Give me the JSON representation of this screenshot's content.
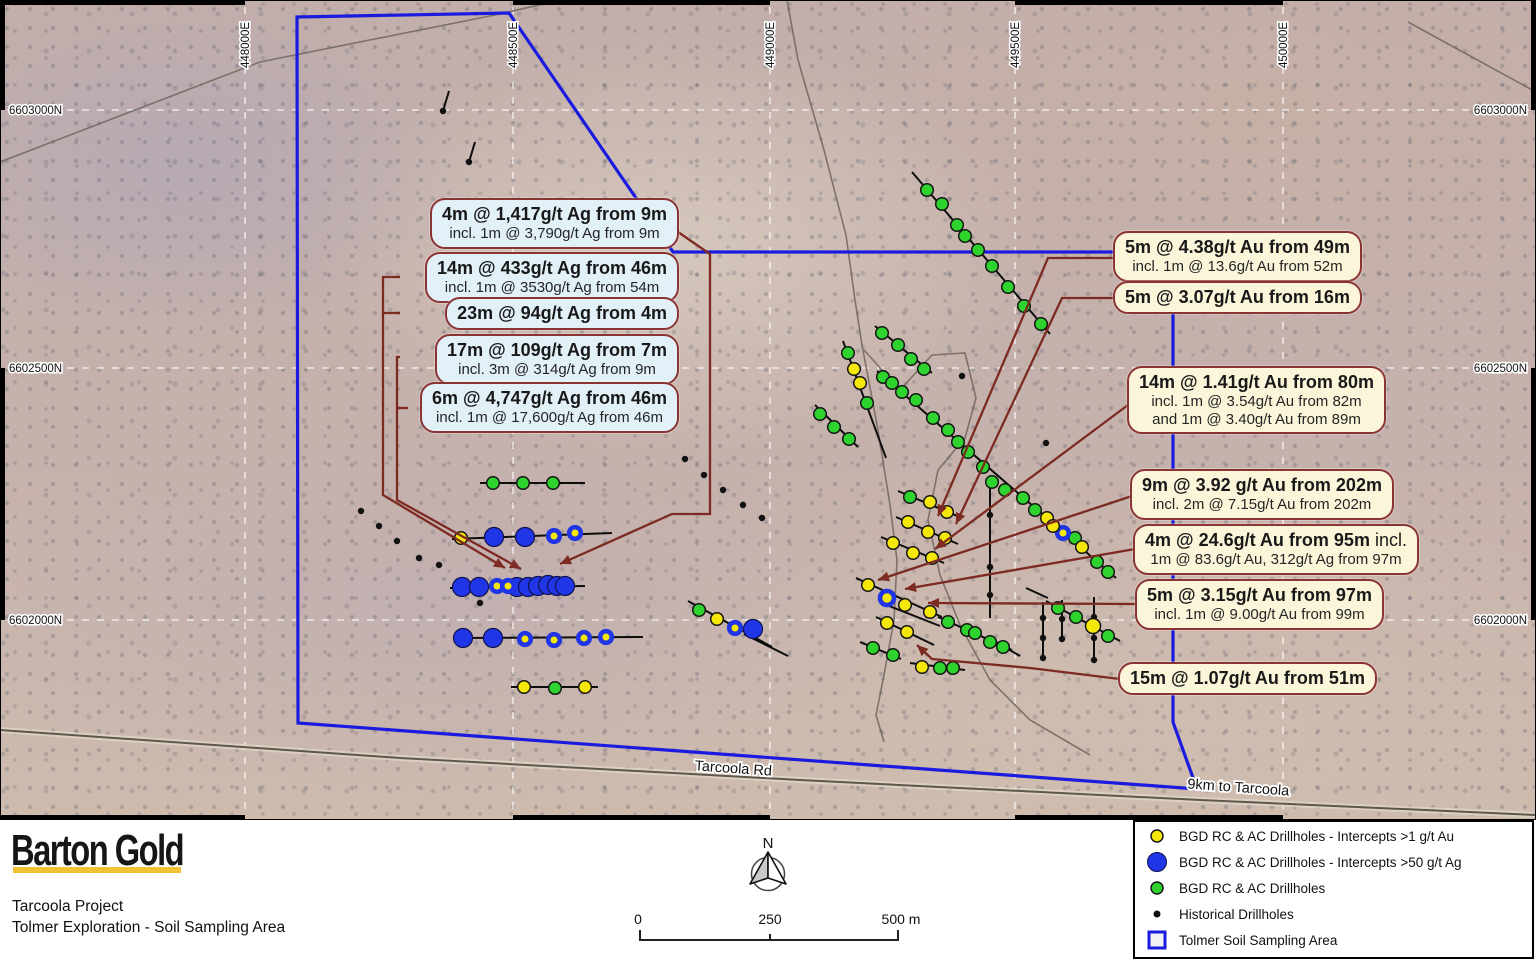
{
  "title": "Tolmer Exploration - Soil Sampling Area map",
  "colors": {
    "polygon_blue": "#1b1bdf",
    "callout_border": "#8b3434",
    "callout_left_bg": "#e2f0f7",
    "callout_right_bg": "#fbf5da",
    "leader": "#7c2a22",
    "dot_yellow": "#f6e70a",
    "dot_green": "#2ed32e",
    "dot_blue": "#2036e6",
    "dot_black": "#111111",
    "trace_black": "#0d0d0d",
    "road_gray": "#5f574d",
    "track_gray": "#6e665c",
    "logo_yellow": "#f2c233"
  },
  "grid": {
    "easting_labels": [
      {
        "text": "448000E",
        "x": 245
      },
      {
        "text": "448500E",
        "x": 513
      },
      {
        "text": "449000E",
        "x": 770
      },
      {
        "text": "449500E",
        "x": 1015
      },
      {
        "text": "450000E",
        "x": 1283
      }
    ],
    "northing_labels": [
      {
        "text": "6603000N",
        "y": 110
      },
      {
        "text": "6602500N",
        "y": 368
      },
      {
        "text": "6602000N",
        "y": 620
      }
    ],
    "vlines": [
      245,
      513,
      770,
      1015,
      1283
    ],
    "hlines": [
      110,
      368,
      620
    ]
  },
  "map_labels": {
    "road": {
      "text": "Tarcoola Rd",
      "x": 733,
      "y": 773,
      "rot": 4
    },
    "distance": {
      "text": "9km to Tarcoola",
      "x": 1238,
      "y": 792,
      "rot": 4
    }
  },
  "callouts_left": [
    {
      "title": "4m @ 1,417g/t Ag from 9m",
      "sub": [
        "incl. 1m @ 3,790g/t Ag from 9m"
      ],
      "top": 198
    },
    {
      "title": "14m @ 433g/t Ag from 46m",
      "sub": [
        "incl. 1m @ 3530g/t Ag from 54m"
      ],
      "top": 252
    },
    {
      "title": "23m @ 94g/t Ag from 4m",
      "sub": [],
      "top": 297
    },
    {
      "title": "17m @ 109g/t Ag from 7m",
      "sub": [
        "incl. 3m @ 314g/t Ag from 9m"
      ],
      "top": 334
    },
    {
      "title": "6m @ 4,747g/t Ag from 46m",
      "sub": [
        "incl. 1m @ 17,600g/t Ag from 46m"
      ],
      "top": 382
    }
  ],
  "callouts_right": [
    {
      "title": "5m @ 4.38g/t Au from 49m",
      "sub": [
        "incl. 1m @ 13.6g/t Au from 52m"
      ],
      "left": 1113,
      "top": 231
    },
    {
      "title": "5m @ 3.07g/t Au from 16m",
      "sub": [],
      "left": 1113,
      "top": 281
    },
    {
      "title": "14m @ 1.41g/t Au from 80m",
      "sub": [
        "incl. 1m @ 3.54g/t Au from 82m",
        "and 1m @ 3.40g/t Au from 89m"
      ],
      "left": 1127,
      "top": 366
    },
    {
      "title": "9m @ 3.92 g/t Au from 202m",
      "sub": [
        "incl. 2m @ 7.15g/t Au from 202m"
      ],
      "left": 1130,
      "top": 469
    },
    {
      "title": "4m @ 24.6g/t Au from 95m",
      "title_suffix": " incl.",
      "sub": [
        "1m @ 83.6g/t Au, 312g/t Ag from 97m"
      ],
      "left": 1133,
      "top": 524
    },
    {
      "title": "5m @ 3.15g/t Au from 97m",
      "sub": [
        "incl. 1m @ 9.00g/t Au from 99m"
      ],
      "left": 1135,
      "top": 579
    },
    {
      "title": "15m @ 1.07g/t Au from 51m",
      "sub": [],
      "left": 1118,
      "top": 662
    }
  ],
  "map_data": {
    "sampling_polygon": "297,17 509,13 673,252 1152,252 1173,272 1173,722 1197,789 298,723",
    "road_main": "0,730 400,758 800,780 1200,800 1536,815",
    "tracks": [
      "787,0 798,60 824,150 846,235 855,300 862,345 878,430 890,505 897,560 894,620 884,675 876,715 884,742",
      "864,350 900,390 932,355 965,353 976,398 965,438 938,470 928,520 940,575 960,625 990,680 1030,720 1090,755",
      "0,162 260,62 500,14 560,0",
      "1408,22 1536,92"
    ],
    "holes": {
      "yellow": [
        [
          461,
          538
        ],
        [
          524,
          687
        ],
        [
          585,
          687
        ],
        [
          717,
          619
        ],
        [
          854,
          369
        ],
        [
          860,
          383
        ],
        [
          930,
          502
        ],
        [
          947,
          512
        ],
        [
          908,
          522
        ],
        [
          928,
          532
        ],
        [
          945,
          538
        ],
        [
          893,
          543
        ],
        [
          913,
          553
        ],
        [
          932,
          558
        ],
        [
          868,
          585
        ],
        [
          905,
          605
        ],
        [
          930,
          612
        ],
        [
          887,
          623
        ],
        [
          907,
          632
        ],
        [
          922,
          667
        ],
        [
          1047,
          518
        ],
        [
          1053,
          526
        ],
        [
          1082,
          547
        ],
        [
          1093,
          626,
          7.5
        ]
      ],
      "green": [
        [
          493,
          483
        ],
        [
          523,
          483
        ],
        [
          553,
          483
        ],
        [
          555,
          688
        ],
        [
          699,
          610
        ],
        [
          927,
          190
        ],
        [
          942,
          204
        ],
        [
          957,
          225
        ],
        [
          965,
          236
        ],
        [
          978,
          250
        ],
        [
          992,
          266
        ],
        [
          1008,
          287
        ],
        [
          1024,
          306
        ],
        [
          1041,
          324
        ],
        [
          848,
          353
        ],
        [
          867,
          403
        ],
        [
          820,
          414
        ],
        [
          834,
          427
        ],
        [
          849,
          439
        ],
        [
          882,
          333
        ],
        [
          898,
          345
        ],
        [
          911,
          359
        ],
        [
          924,
          369
        ],
        [
          883,
          377
        ],
        [
          892,
          383
        ],
        [
          902,
          392
        ],
        [
          916,
          400
        ],
        [
          933,
          418
        ],
        [
          948,
          430
        ],
        [
          958,
          442
        ],
        [
          968,
          452
        ],
        [
          983,
          467
        ],
        [
          992,
          482
        ],
        [
          1005,
          490
        ],
        [
          1023,
          498
        ],
        [
          1035,
          510
        ],
        [
          1075,
          538
        ],
        [
          1097,
          562
        ],
        [
          1108,
          572
        ],
        [
          910,
          497
        ],
        [
          873,
          648
        ],
        [
          893,
          655
        ],
        [
          940,
          668
        ],
        [
          953,
          668
        ],
        [
          948,
          622
        ],
        [
          967,
          630
        ],
        [
          975,
          633
        ],
        [
          990,
          642
        ],
        [
          1003,
          647
        ],
        [
          1058,
          608
        ],
        [
          1076,
          617
        ],
        [
          1108,
          636
        ]
      ],
      "blue": [
        [
          494,
          537
        ],
        [
          525,
          537
        ],
        [
          462,
          587
        ],
        [
          479,
          587
        ],
        [
          517,
          587
        ],
        [
          528,
          587
        ],
        [
          538,
          586
        ],
        [
          548,
          585
        ],
        [
          557,
          586
        ],
        [
          565,
          586
        ],
        [
          463,
          638
        ],
        [
          493,
          638
        ],
        [
          753,
          629
        ]
      ],
      "blue_ring": [
        [
          554,
          536
        ],
        [
          575,
          533
        ],
        [
          497,
          586
        ],
        [
          508,
          586
        ],
        [
          525,
          639
        ],
        [
          554,
          640
        ],
        [
          584,
          638
        ],
        [
          606,
          637
        ],
        [
          735,
          628
        ],
        [
          887,
          598,
          7
        ],
        [
          1063,
          533
        ]
      ],
      "black": [
        [
          361,
          511
        ],
        [
          379,
          526
        ],
        [
          397,
          541
        ],
        [
          419,
          558
        ],
        [
          439,
          565
        ],
        [
          480,
          603
        ],
        [
          685,
          459
        ],
        [
          704,
          475
        ],
        [
          723,
          490
        ],
        [
          743,
          505
        ],
        [
          762,
          518
        ],
        [
          443,
          111
        ],
        [
          469,
          162
        ],
        [
          962,
          376
        ],
        [
          1046,
          443
        ],
        [
          990,
          515
        ],
        [
          990,
          567
        ],
        [
          990,
          595
        ],
        [
          1043,
          618
        ],
        [
          1043,
          638
        ],
        [
          1043,
          658
        ],
        [
          1062,
          619
        ],
        [
          1062,
          639
        ],
        [
          1094,
          617
        ],
        [
          1094,
          638
        ],
        [
          1094,
          660
        ]
      ]
    },
    "traces": [
      [
        480,
        483,
        585,
        483
      ],
      [
        452,
        539,
        612,
        533
      ],
      [
        450,
        588,
        585,
        586
      ],
      [
        453,
        638,
        643,
        637
      ],
      [
        511,
        687,
        598,
        687
      ],
      [
        688,
        601,
        772,
        647
      ],
      [
        744,
        634,
        788,
        656
      ],
      [
        912,
        172,
        1050,
        334
      ],
      [
        843,
        341,
        886,
        458
      ],
      [
        815,
        405,
        858,
        447
      ],
      [
        875,
        326,
        932,
        373
      ],
      [
        877,
        371,
        1116,
        578
      ],
      [
        898,
        491,
        962,
        518
      ],
      [
        896,
        517,
        958,
        544
      ],
      [
        881,
        537,
        944,
        563
      ],
      [
        856,
        578,
        942,
        617
      ],
      [
        884,
        604,
        940,
        626
      ],
      [
        876,
        617,
        934,
        645
      ],
      [
        860,
        642,
        901,
        659
      ],
      [
        910,
        663,
        965,
        670
      ],
      [
        938,
        617,
        1012,
        650
      ],
      [
        1046,
        601,
        1120,
        641
      ],
      [
        996,
        642,
        1020,
        656
      ],
      [
        443,
        111,
        449,
        91
      ],
      [
        469,
        162,
        475,
        142
      ],
      [
        990,
        478,
        990,
        618
      ],
      [
        1043,
        602,
        1043,
        660
      ],
      [
        1062,
        600,
        1062,
        640
      ],
      [
        1094,
        597,
        1094,
        662
      ],
      [
        1026,
        588,
        1048,
        598
      ]
    ],
    "leaders": [
      {
        "pts": "678,232 710,254 710,514 672,514 560,564",
        "arrow": true
      },
      {
        "pts": "400,277 383,277 383,495 505,568",
        "arrow": true
      },
      {
        "pts": "400,313 383,313",
        "arrow": false
      },
      {
        "pts": "400,357 397,357 397,500 521,569",
        "arrow": true
      },
      {
        "pts": "408,408 397,408",
        "arrow": false
      },
      {
        "pts": "1115,258 1048,258 938,516",
        "arrow": true
      },
      {
        "pts": "1115,298 1062,298 956,524",
        "arrow": true
      },
      {
        "pts": "1128,405 935,549",
        "arrow": true
      },
      {
        "pts": "1132,496 878,580",
        "arrow": true
      },
      {
        "pts": "1135,549 905,589",
        "arrow": true
      },
      {
        "pts": "1137,604 928,603",
        "arrow": true
      },
      {
        "pts": "1128,680 1030,668 932,659 917,645",
        "arrow": true
      }
    ]
  },
  "footer": {
    "logo": "Barton Gold",
    "project": "Tarcoola Project",
    "subtitle": "Tolmer Exploration - Soil Sampling Area",
    "north_label": "N",
    "scale": {
      "labels": [
        {
          "text": "0",
          "x": 638
        },
        {
          "text": "250",
          "x": 770
        },
        {
          "text": "500 m",
          "x": 901
        }
      ]
    },
    "legend": [
      {
        "icon": "yellow-dot",
        "label": "BGD RC & AC Drillholes - Intercepts >1 g/t Au"
      },
      {
        "icon": "blue-dot",
        "label": "BGD RC & AC Drillholes - Intercepts >50 g/t Ag"
      },
      {
        "icon": "green-dot",
        "label": "BGD RC & AC Drillholes"
      },
      {
        "icon": "black-dot",
        "label": "Historical Drillholes"
      },
      {
        "icon": "blue-square",
        "label": "Tolmer Soil Sampling Area"
      }
    ]
  }
}
